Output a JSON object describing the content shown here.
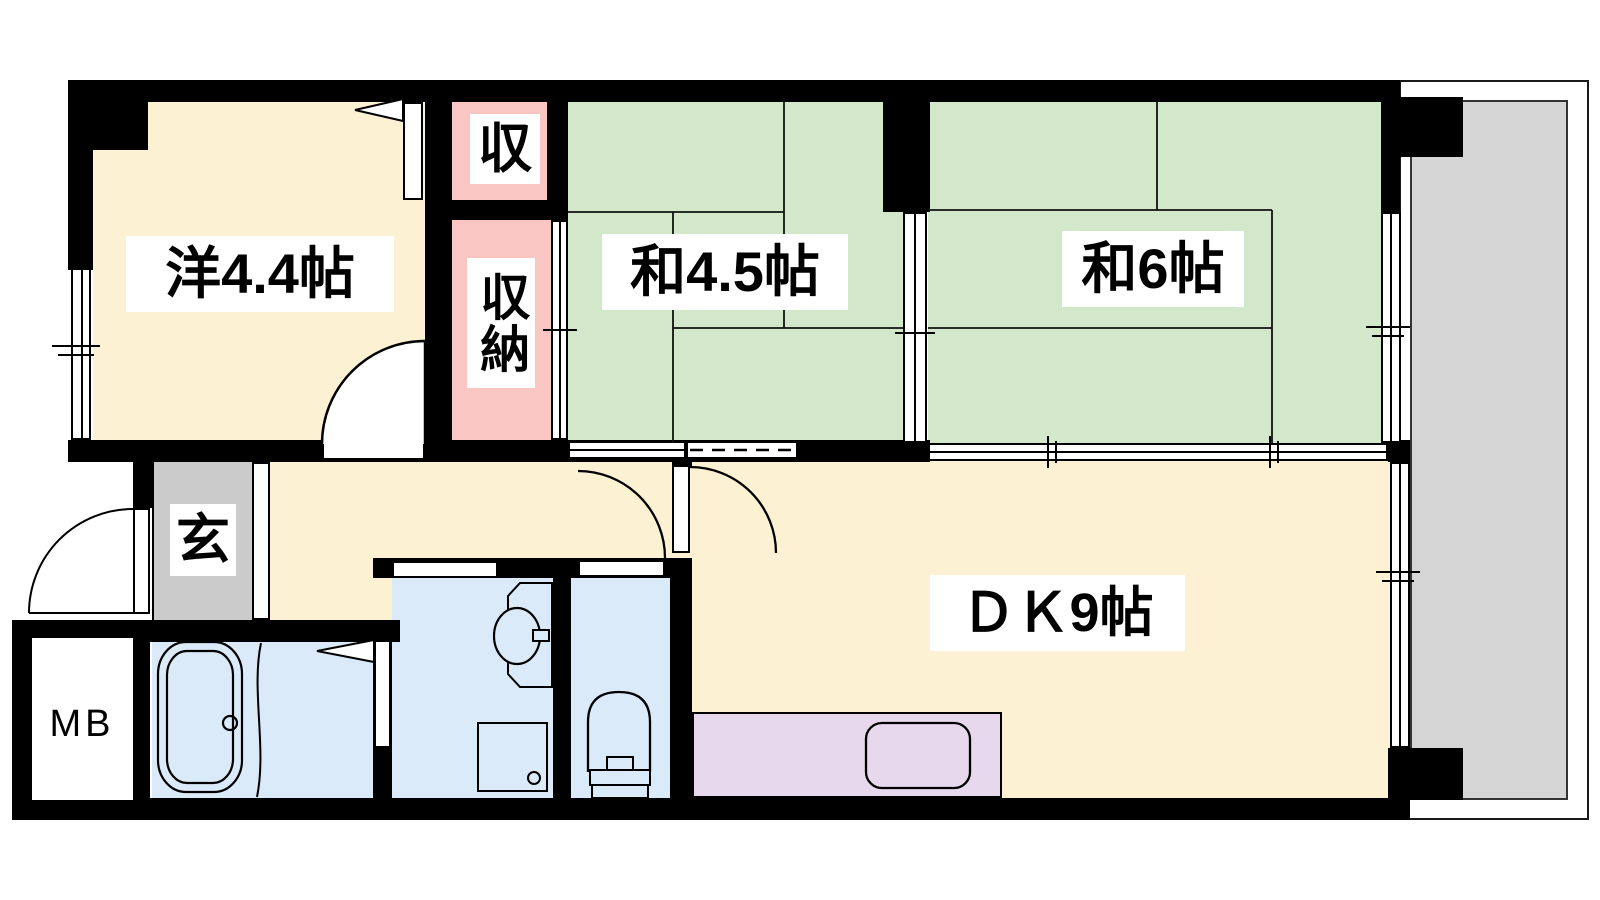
{
  "floorplan": {
    "rooms": {
      "western": "洋4.4帖",
      "tatami_45": "和4.5帖",
      "tatami_6": "和6帖",
      "dk": "ＤＫ9帖",
      "entrance": "玄",
      "closet_small": "収",
      "closet_tall": "収納",
      "meter_box": "MB"
    },
    "colors": {
      "wall": "#000000",
      "flooring": "#FCF1D2",
      "tatami": "#D3E7CB",
      "closet": "#F9C6C4",
      "entrance_floor": "#CBCBCB",
      "wet_room": "#DBEAF9",
      "kitchen_counter": "#E7D8EE",
      "balcony": "#D5D5D5"
    }
  }
}
